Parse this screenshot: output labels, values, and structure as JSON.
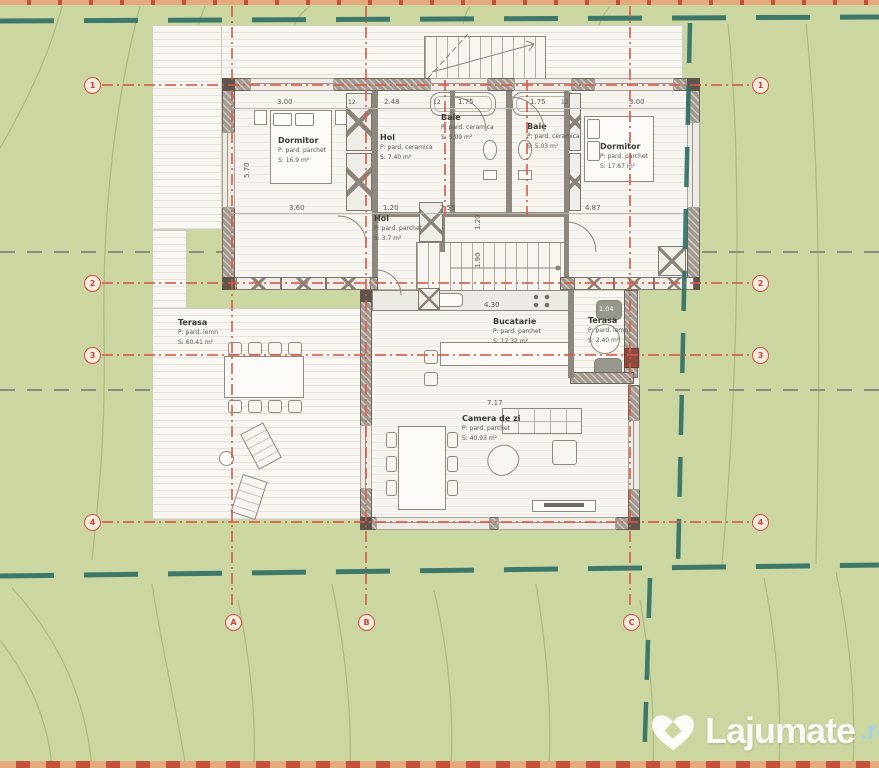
{
  "colors": {
    "site_green": "#cbd6a0",
    "boundary_teal": "#2d6f64",
    "grid_red": "#d95847",
    "wall_grey": "#a29a90",
    "watermark_blue": "#9fd2e6"
  },
  "rooms": {
    "dormitor_left": {
      "name": "Dormitor",
      "floor": "P: pard. parchet",
      "area": "S: 16.9 m²"
    },
    "hol_sus": {
      "name": "Hol",
      "floor": "P: pard. ceramica",
      "area": "S: 7.40 m²"
    },
    "baie_1": {
      "name": "Baie",
      "floor": "P: pard. ceramica",
      "area": "S: 5.09 m²"
    },
    "baie_2": {
      "name": "Baie",
      "floor": "P: pard. ceramica",
      "area": "S: 5.03 m²"
    },
    "dormitor_right": {
      "name": "Dormitor",
      "floor": "P: pard. parchet",
      "area": "S: 17.67 m²"
    },
    "hol_jos": {
      "name": "Hol",
      "floor": "P: pard. parchet",
      "area": "S: 3.7 m²"
    },
    "terasa_left": {
      "name": "Terasa",
      "floor": "P: pard. lemn",
      "area": "S: 60.41 m²"
    },
    "bucatarie": {
      "name": "Bucatarie",
      "floor": "P: pard. parchet",
      "area": "S: 12.32 m²"
    },
    "terasa_right": {
      "name": "Terasa",
      "floor": "P: pard. lemn",
      "area": "S: 2.40 m²"
    },
    "camera_zi": {
      "name": "Camera de zi",
      "floor": "P: pard. parchet",
      "area": "S: 40.93 m²"
    }
  },
  "dims": {
    "top": [
      "3.00",
      "2.48",
      "1.75",
      "1.75",
      "3.00"
    ],
    "mid": [
      "3.60",
      "1.20",
      "2.55",
      "4.87"
    ],
    "wall_thickness": "12",
    "kitchen": "4.30",
    "terrace_right": "1.04",
    "living": "7.17",
    "vertical": [
      "5.70",
      "1.20",
      "1.90"
    ]
  },
  "grid": {
    "rows": [
      "1",
      "2",
      "3",
      "4"
    ],
    "cols": [
      "A",
      "B",
      "C"
    ]
  },
  "watermark": {
    "name": "Lajumate",
    "tld": ".ro"
  }
}
